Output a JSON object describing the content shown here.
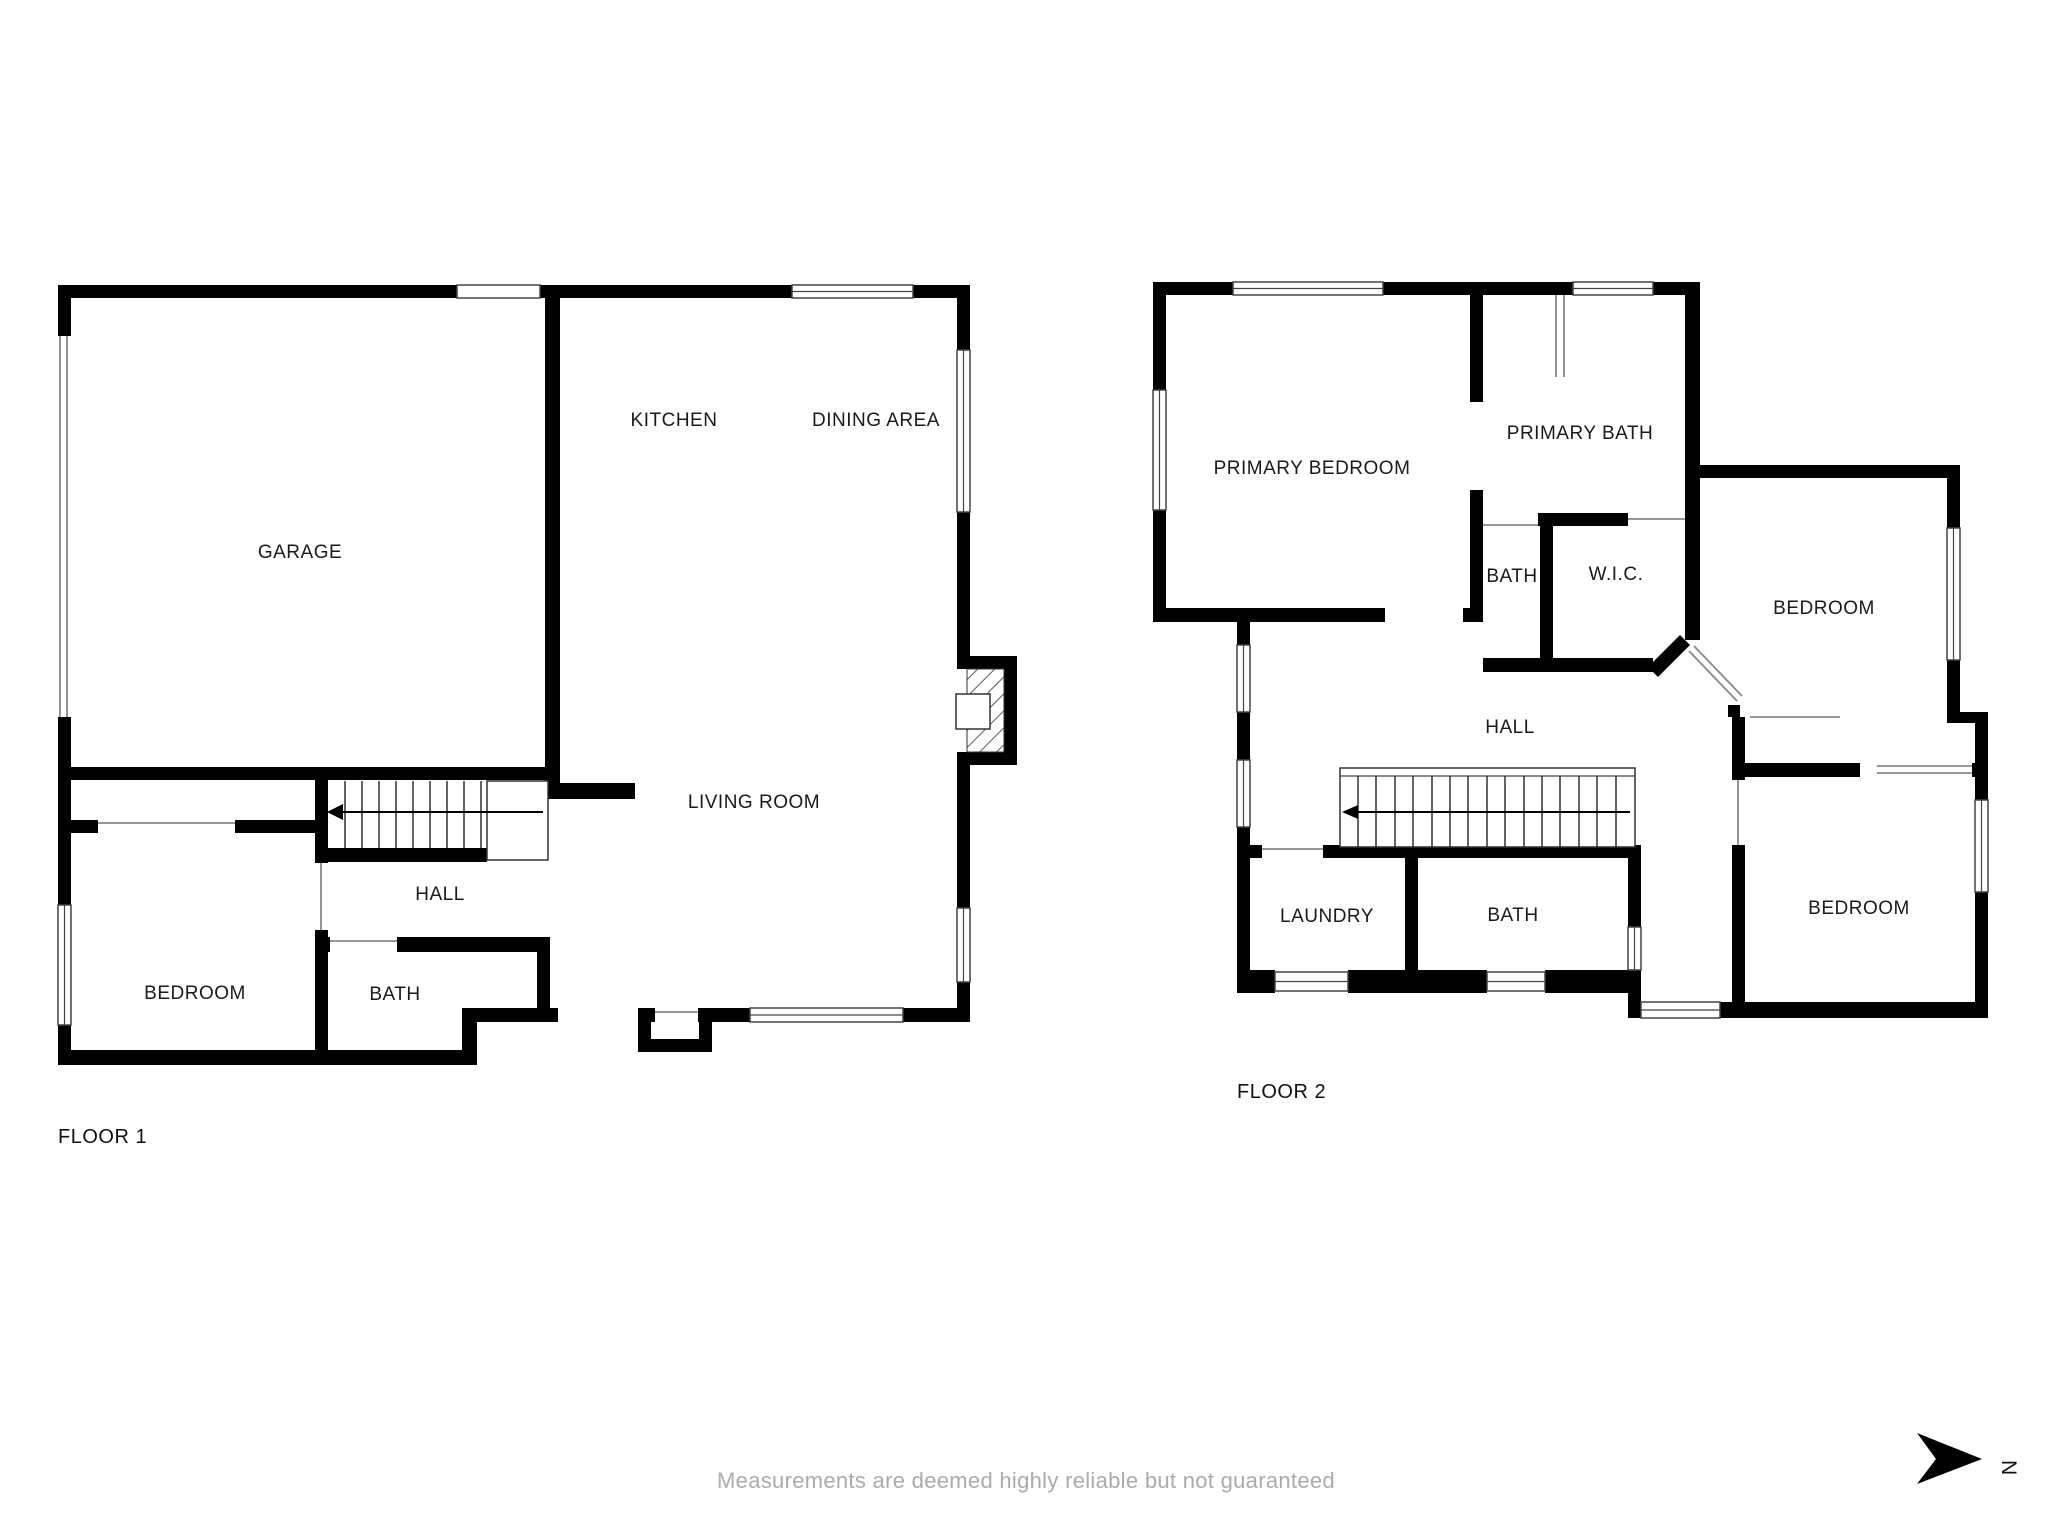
{
  "floor1": {
    "title": "FLOOR 1",
    "rooms": {
      "garage": "GARAGE",
      "kitchen": "KITCHEN",
      "dining": "DINING AREA",
      "living": "LIVING ROOM",
      "hall": "HALL",
      "bedroom": "BEDROOM",
      "bath": "BATH"
    }
  },
  "floor2": {
    "title": "FLOOR 2",
    "rooms": {
      "primary_bedroom": "PRIMARY BEDROOM",
      "primary_bath": "PRIMARY BATH",
      "bath_upper": "BATH",
      "wic": "W.I.C.",
      "bedroom_ne": "BEDROOM",
      "hall": "HALL",
      "laundry": "LAUNDRY",
      "bath_lower": "BATH",
      "bedroom_se": "BEDROOM"
    }
  },
  "footer": {
    "disclaimer": "Measurements are deemed highly reliable but not guaranteed",
    "north_label": "N"
  },
  "colors": {
    "wall": "#000000",
    "label": "#1a1a1a",
    "window_frame": "#444444",
    "opening_line": "#888888",
    "muted_text": "#ababab"
  }
}
